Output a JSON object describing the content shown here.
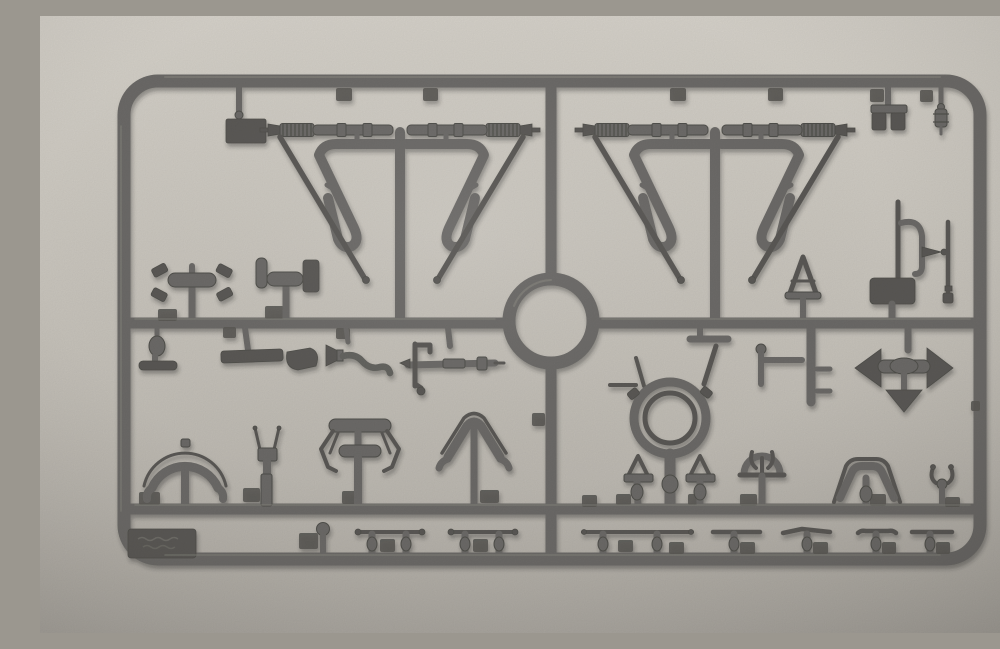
{
  "scene": {
    "type": "photograph",
    "subject": "Gray injection-molded plastic model kit sprue with unassembled parts on a rectangular runner frame",
    "background": "plain light warm-gray surface with soft vignette",
    "text_on_object": "faint illegible embossed marking on a small dark plate at the lower-left inside corner of the frame"
  },
  "colors": {
    "background_top": "#d7d3cb",
    "background_bottom": "#b3afa8",
    "plastic_mid": "#6c6b67",
    "plastic_dark": "#504f4b",
    "plastic_light": "#8f8e88",
    "part_dark": "#5a5955"
  },
  "sprue": {
    "frame_shape": "rounded rectangle runner frame",
    "runners": [
      "outer frame",
      "vertical center runner",
      "horizontal mid runner",
      "lower horizontal runner",
      "left panel sub-runner",
      "right panel sub-runner",
      "central circular runner ring"
    ],
    "parts": [
      "small rectangular plate",
      "twin-block bracket",
      "finial post",
      "machine-gun barrel x4",
      "hairpin triangle mount tube x4",
      "diagonal support strut x4",
      "cross clamp with claws x2",
      "knob pin",
      "flat bar",
      "curved blade",
      "ribbed flex hose",
      "axle shaft with C-bracket",
      "crank arm with spokes",
      "gun ring mount with inner ring",
      "A-frame pedestal x2",
      "thin rod x2",
      "J-tube with nozzle",
      "small A-frame tripod",
      "rectangular box plate",
      "L-bracket with pegs",
      "three-way arrowhead piece",
      "horseshoe arch stand",
      "fork stand",
      "articulated T-arm stand",
      "A-frame arch stand",
      "horned dome part",
      "wide arch part",
      "small trident part",
      "ball pin",
      "handrail with two posts x3",
      "footstep bar on post x4",
      "embossed marking plate"
    ]
  }
}
